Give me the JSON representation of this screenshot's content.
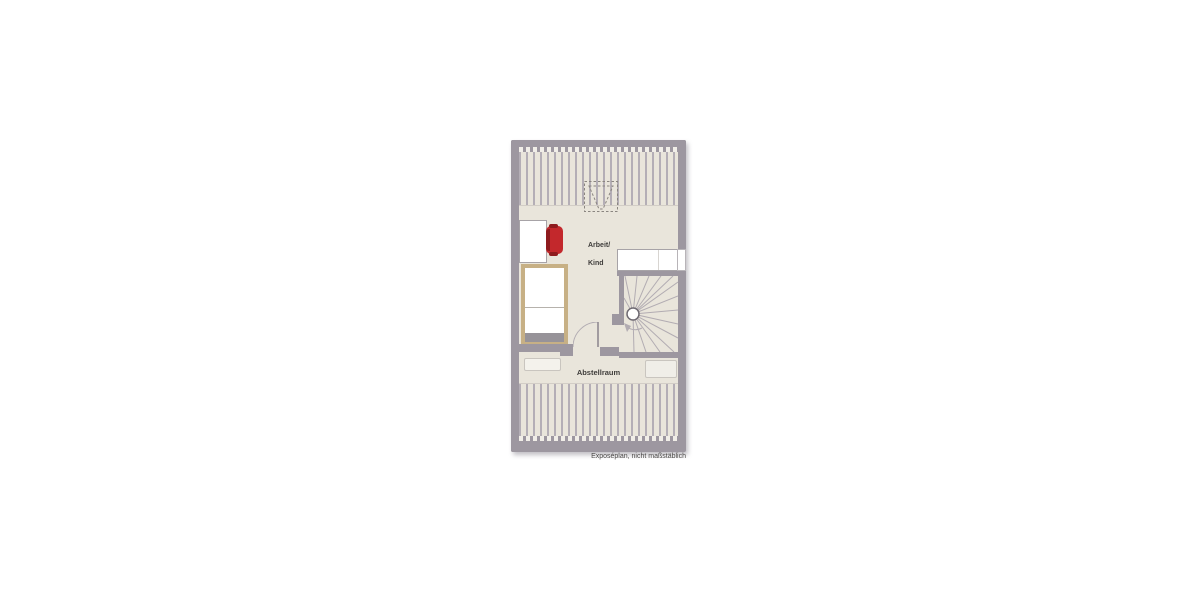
{
  "plan": {
    "type": "floor-plan-attic-storey",
    "labels": {
      "room1_line1": "Arbeit/",
      "room1_line2": "Kind",
      "room2": "Abstellraum",
      "footnote": "Exposéplan, nicht maßstäblich"
    },
    "icons": {
      "staircase": "spiral-staircase-icon",
      "bed": "bed-icon",
      "desk": "desk-icon",
      "chair": "office-chair-icon",
      "door": "door-swing-icon",
      "chimney": "dashed-chimney-outline-icon",
      "roof_slope": "roof-slope-hatch"
    },
    "colors": {
      "wall": "#9d97a0",
      "wall_dark": "#857f89",
      "floor": "#e9e5db",
      "hatch": "#b4aeb6",
      "notch": "#f1eee8",
      "bed_frame": "#c7b085",
      "chair_red": "#c3282c",
      "chair_red_dark": "#8e1b1e",
      "furniture_border": "#a7a3a7",
      "shelf_fill": "#f4f2ec",
      "shelf_border": "#c9c5bf",
      "stair_line": "#b2acb2",
      "stair_pole": "#6f6a72",
      "dashed_outline": "#8a8580",
      "text": "#3e3c3a",
      "footnote_text": "#4a4846"
    }
  }
}
